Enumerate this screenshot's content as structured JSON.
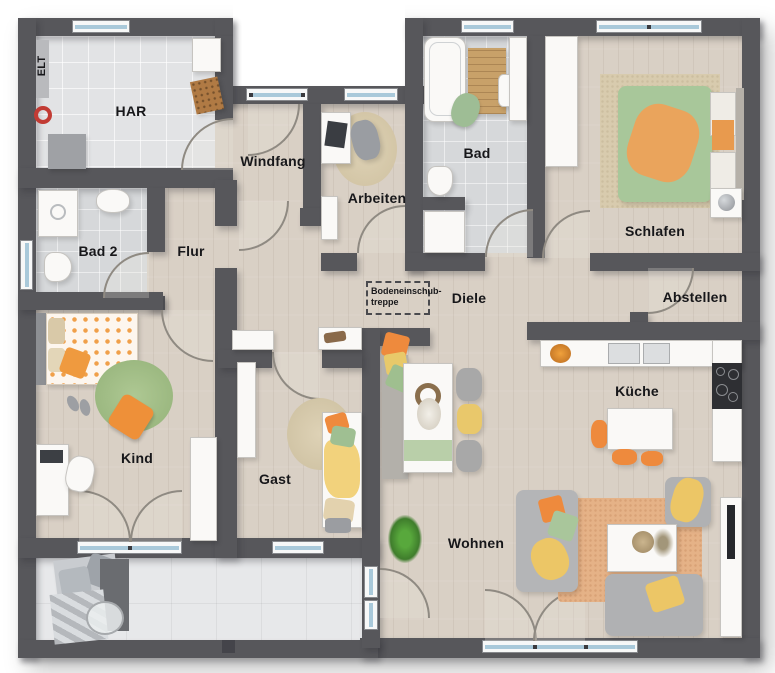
{
  "app": {
    "type": "architectural-floor-plan"
  },
  "labels": {
    "elt": "ELT",
    "har": "HAR",
    "windfang": "Windfang",
    "arbeiten": "Arbeiten",
    "bad": "Bad",
    "schlafen": "Schlafen",
    "bad2": "Bad 2",
    "flur": "Flur",
    "diele": "Diele",
    "abstellen": "Abstellen",
    "treppe_line1": "Bodeneinschub-",
    "treppe_line2": "treppe",
    "kind": "Kind",
    "gast": "Gast",
    "kueche": "Küche",
    "wohnen": "Wohnen"
  },
  "colors": {
    "wall": "#57575b",
    "wood_floor": "#d9d0c5",
    "bath_tile": "#d6d8da",
    "har_tile": "#e2e3e5",
    "terrace_tile": "#e7e8ea",
    "window_glass": "#a9c9da",
    "accent_orange": "#ee8a3d",
    "accent_green": "#a9c69b",
    "accent_yellow": "#ecc666"
  }
}
